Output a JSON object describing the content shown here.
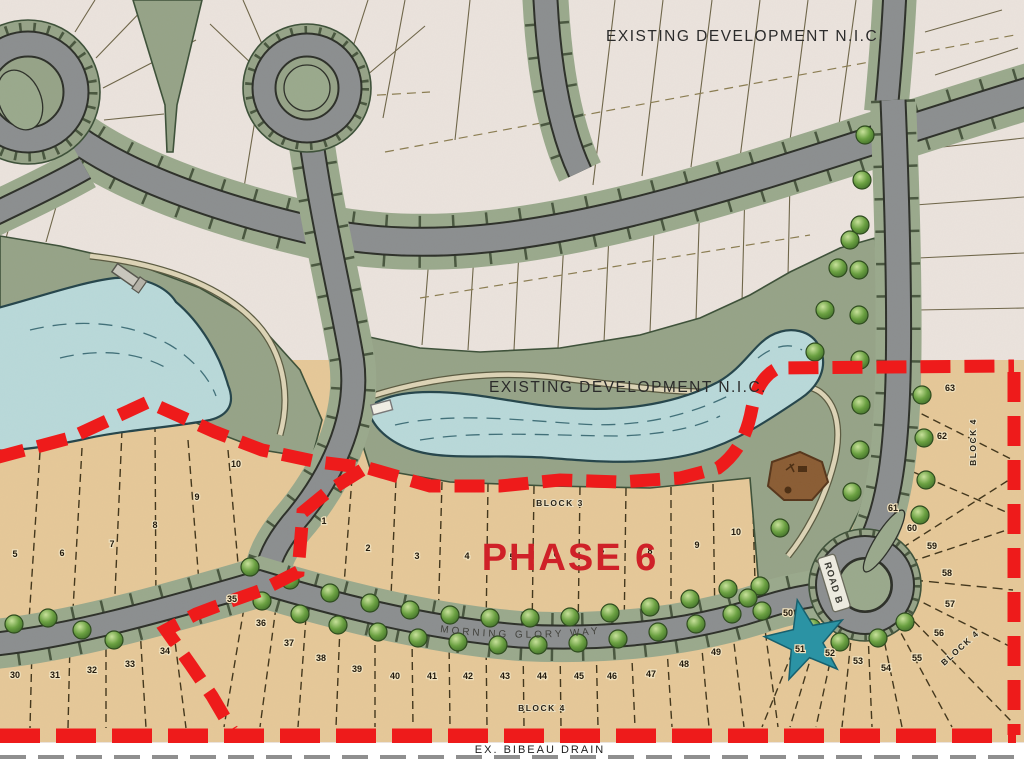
{
  "labels": {
    "existing_top": "EXISTING DEVELOPMENT N.I.C.",
    "existing_mid": "EXISTING DEVELOPMENT N.I.C.",
    "phase": "PHASE 6",
    "morning_glory": "MORNING  GLORY  WAY",
    "road_b": "ROAD  B",
    "block_3": "BLOCK  3",
    "block_4_bottom": "BLOCK  4",
    "block_4_right": "BLOCK  4",
    "block_4_diagonal": "BLOCK  4",
    "drain": "EX.   BIBEAU   DRAIN"
  },
  "lot_numbers": [
    {
      "n": "5",
      "x": 15,
      "y": 557
    },
    {
      "n": "6",
      "x": 62,
      "y": 556
    },
    {
      "n": "7",
      "x": 112,
      "y": 547
    },
    {
      "n": "8",
      "x": 155,
      "y": 528
    },
    {
      "n": "9",
      "x": 197,
      "y": 500
    },
    {
      "n": "10",
      "x": 236,
      "y": 467
    },
    {
      "n": "1",
      "x": 324,
      "y": 524
    },
    {
      "n": "2",
      "x": 368,
      "y": 551
    },
    {
      "n": "3",
      "x": 417,
      "y": 559
    },
    {
      "n": "4",
      "x": 467,
      "y": 559
    },
    {
      "n": "5",
      "x": 512,
      "y": 560
    },
    {
      "n": "6",
      "x": 556,
      "y": 557
    },
    {
      "n": "7",
      "x": 602,
      "y": 557
    },
    {
      "n": "8",
      "x": 650,
      "y": 554
    },
    {
      "n": "9",
      "x": 697,
      "y": 548
    },
    {
      "n": "10",
      "x": 736,
      "y": 535
    },
    {
      "n": "30",
      "x": 15,
      "y": 678
    },
    {
      "n": "31",
      "x": 55,
      "y": 678
    },
    {
      "n": "32",
      "x": 92,
      "y": 673
    },
    {
      "n": "33",
      "x": 130,
      "y": 667
    },
    {
      "n": "34",
      "x": 165,
      "y": 654
    },
    {
      "n": "35",
      "x": 232,
      "y": 602
    },
    {
      "n": "36",
      "x": 261,
      "y": 626
    },
    {
      "n": "37",
      "x": 289,
      "y": 646
    },
    {
      "n": "38",
      "x": 321,
      "y": 661
    },
    {
      "n": "39",
      "x": 357,
      "y": 672
    },
    {
      "n": "40",
      "x": 395,
      "y": 679
    },
    {
      "n": "41",
      "x": 432,
      "y": 679
    },
    {
      "n": "42",
      "x": 468,
      "y": 679
    },
    {
      "n": "43",
      "x": 505,
      "y": 679
    },
    {
      "n": "44",
      "x": 542,
      "y": 679
    },
    {
      "n": "45",
      "x": 579,
      "y": 679
    },
    {
      "n": "46",
      "x": 612,
      "y": 679
    },
    {
      "n": "47",
      "x": 651,
      "y": 677
    },
    {
      "n": "48",
      "x": 684,
      "y": 667
    },
    {
      "n": "49",
      "x": 716,
      "y": 655
    },
    {
      "n": "50",
      "x": 788,
      "y": 616
    },
    {
      "n": "51",
      "x": 800,
      "y": 652
    },
    {
      "n": "52",
      "x": 830,
      "y": 656
    },
    {
      "n": "53",
      "x": 858,
      "y": 664
    },
    {
      "n": "54",
      "x": 886,
      "y": 671
    },
    {
      "n": "55",
      "x": 917,
      "y": 661
    },
    {
      "n": "56",
      "x": 939,
      "y": 636
    },
    {
      "n": "57",
      "x": 950,
      "y": 607
    },
    {
      "n": "58",
      "x": 947,
      "y": 576
    },
    {
      "n": "59",
      "x": 932,
      "y": 549
    },
    {
      "n": "60",
      "x": 912,
      "y": 531
    },
    {
      "n": "61",
      "x": 893,
      "y": 511
    },
    {
      "n": "62",
      "x": 942,
      "y": 439
    },
    {
      "n": "63",
      "x": 950,
      "y": 391
    }
  ],
  "icons": {
    "tree": "tree-icon",
    "star": "star-marker-icon",
    "playground": "playground-icon",
    "dock": "dock-icon"
  },
  "colors": {
    "existing_background": "#ebe3dd",
    "phase_lots_tan": "#e6c898",
    "park_green": "#96a387",
    "verge_green": "#9aa98c",
    "pond_blue": "#b9d9da",
    "road_gray": "#8b8e8f",
    "boundary_red": "#ee1b1b",
    "phase_text_red": "#cf2128",
    "star_teal": "#2b93a4",
    "tree_green": "#5d8f3c",
    "playground_brown": "#8a5c33"
  }
}
